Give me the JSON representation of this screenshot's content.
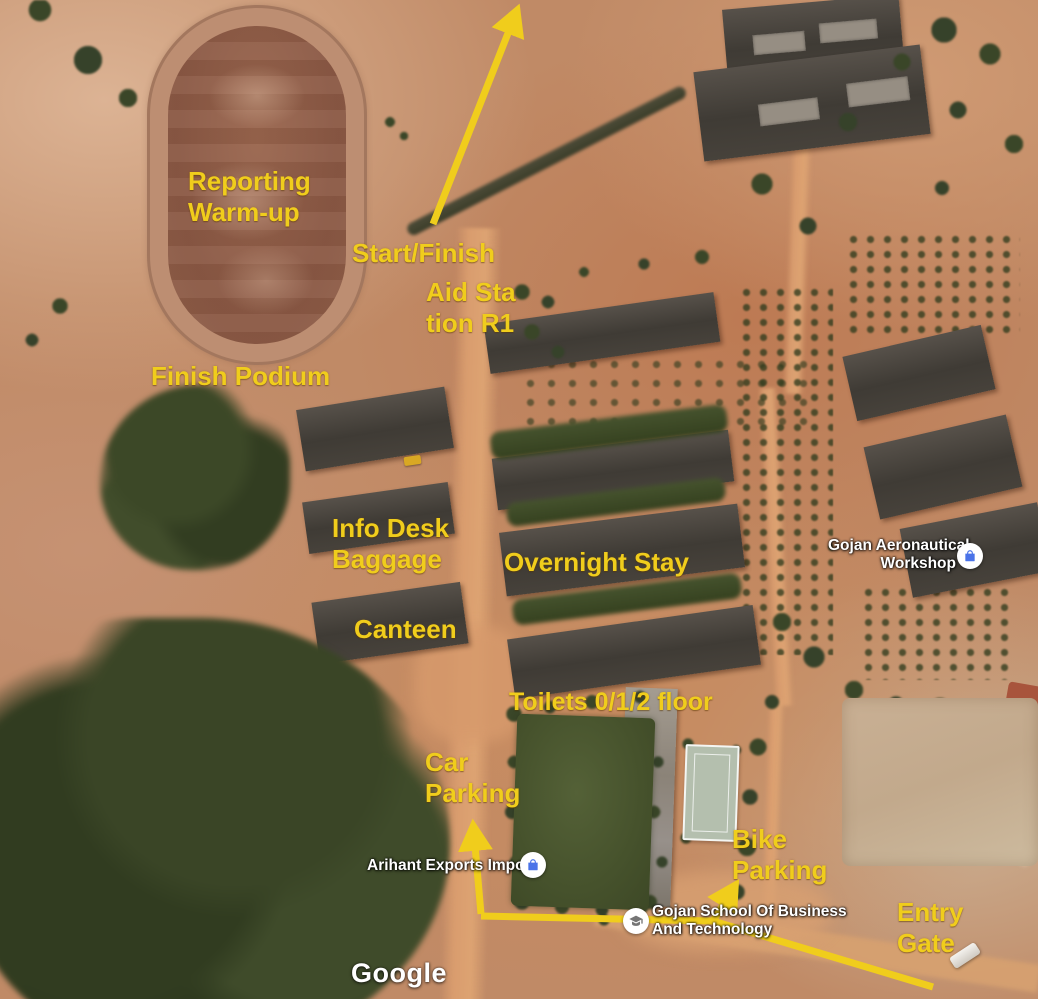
{
  "map": {
    "attribution": "Google",
    "annotation_color": "#f0cd1c",
    "annotations": [
      {
        "id": "reporting-warmup",
        "lines": [
          "Reporting",
          "Warm-up"
        ]
      },
      {
        "id": "start-finish",
        "lines": [
          "Start/Finish"
        ]
      },
      {
        "id": "aid-station-r1",
        "lines": [
          "Aid Sta",
          "tion R1"
        ]
      },
      {
        "id": "finish-podium",
        "lines": [
          "Finish Podium"
        ]
      },
      {
        "id": "info-desk-baggage",
        "lines": [
          "Info Desk",
          "Baggage"
        ]
      },
      {
        "id": "overnight-stay",
        "lines": [
          "Overnight Stay"
        ]
      },
      {
        "id": "canteen",
        "lines": [
          "Canteen"
        ]
      },
      {
        "id": "toilets",
        "lines": [
          "Toilets 0/1/2 floor"
        ]
      },
      {
        "id": "car-parking",
        "lines": [
          "Car",
          "Parking"
        ]
      },
      {
        "id": "bike-parking",
        "lines": [
          "Bike",
          "Parking"
        ]
      },
      {
        "id": "entry-gate",
        "lines": [
          "Entry",
          "Gate"
        ]
      }
    ],
    "places": [
      {
        "id": "gojan-aeronautical-workshop",
        "lines": [
          "Gojan Aeronautical",
          "Workshop"
        ],
        "icon": "shopping-bag-icon"
      },
      {
        "id": "arihant-exports-imports",
        "lines": [
          "Arihant Exports Imports"
        ],
        "icon": "shopping-bag-icon"
      },
      {
        "id": "gojan-school-of-business",
        "lines": [
          "Gojan School Of Business",
          "And Technology"
        ],
        "icon": "school-icon"
      }
    ]
  }
}
